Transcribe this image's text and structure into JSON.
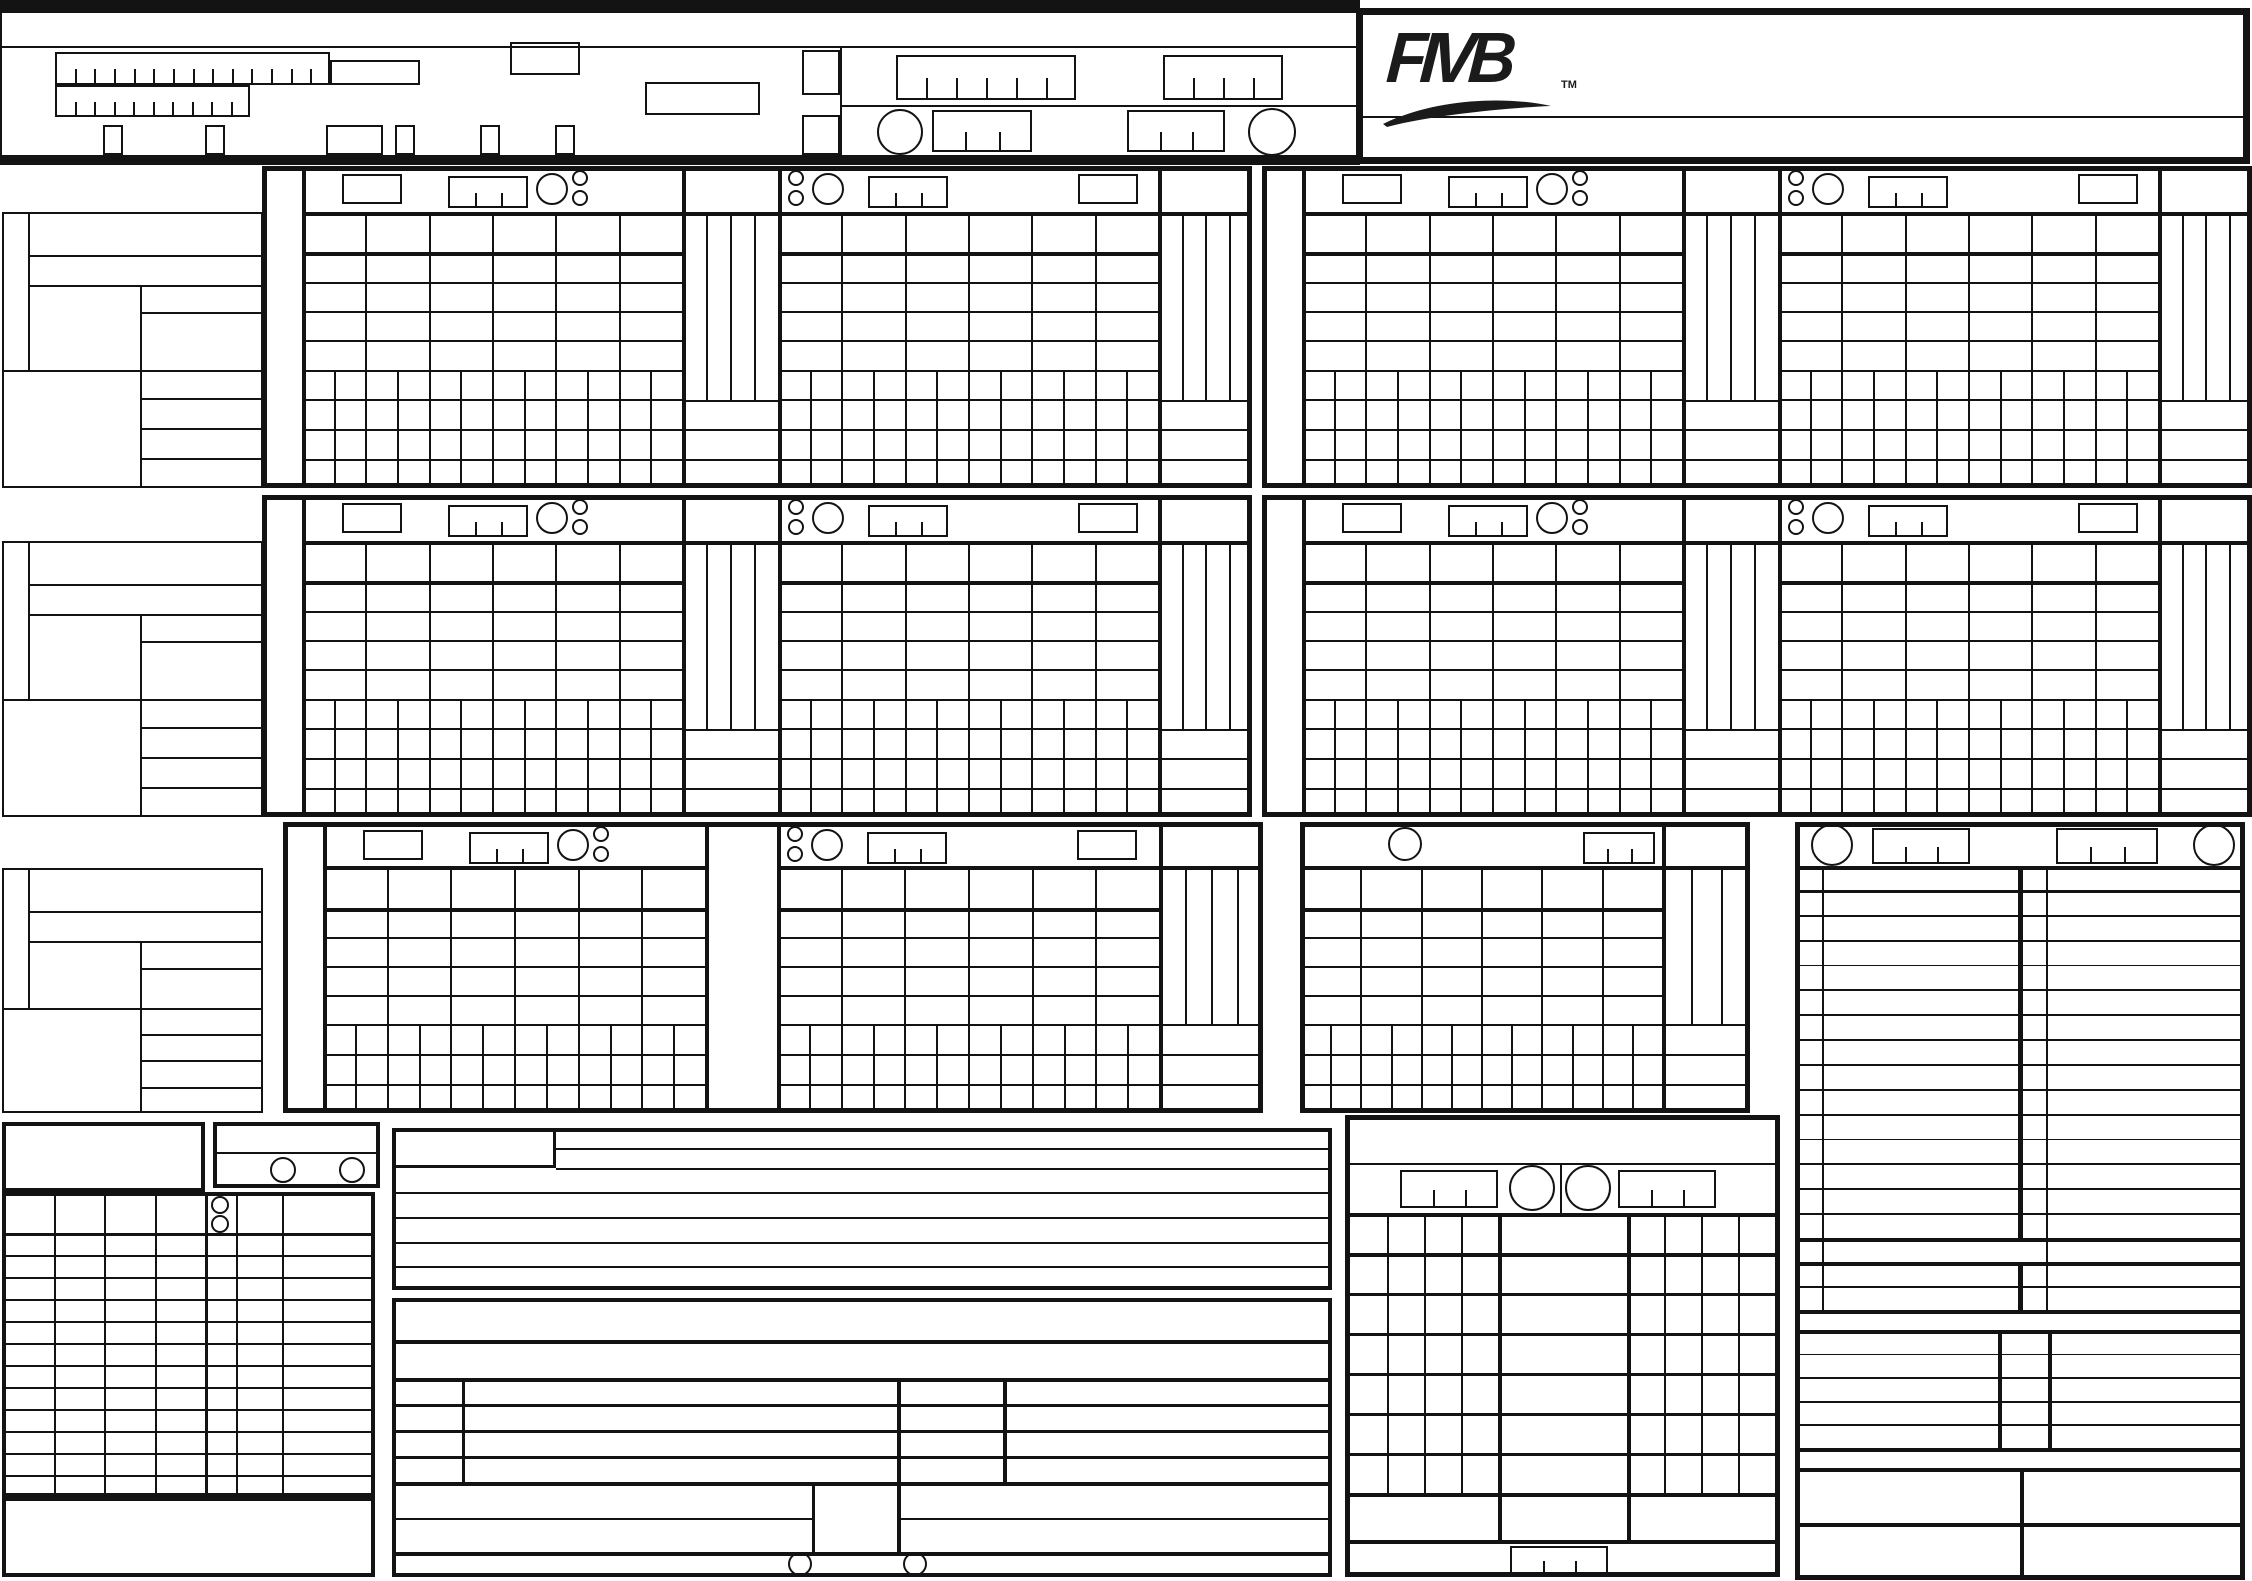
{
  "brand": {
    "name": "FIVB",
    "tm": "TM"
  },
  "palette": {
    "ink": "#131313",
    "paper": "#ffffff"
  },
  "sheet": {
    "state": "blank",
    "visible_text_other_than_logo": ""
  }
}
